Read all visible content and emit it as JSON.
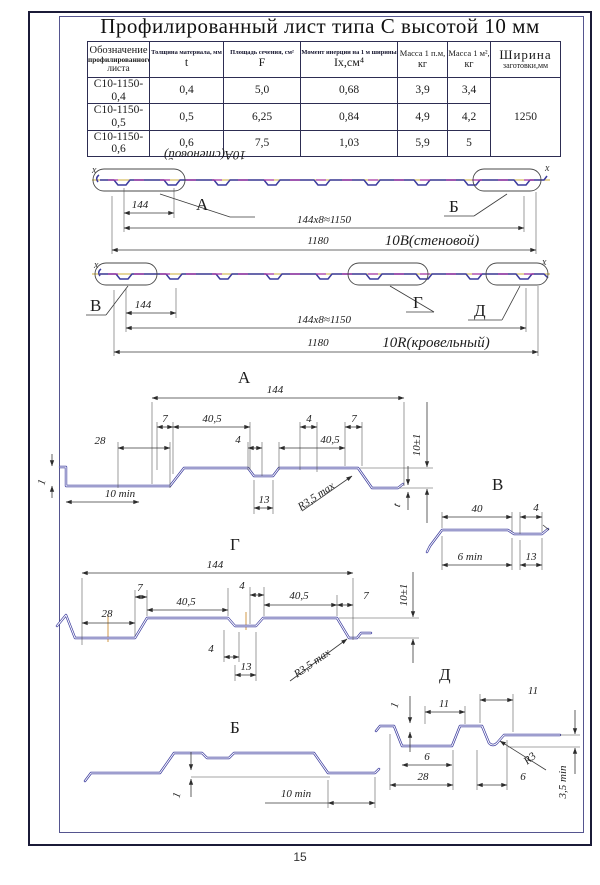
{
  "page_number": "15",
  "title": "Профилированный лист типа С высотой 10 мм",
  "table": {
    "col1_line1": "Обозначение",
    "col1_line2": "профилированного",
    "col1_line3": "листа",
    "col2_name": "Толщина материала, мм",
    "col2_sym": "t",
    "col3_name": "Площадь сечения, см²",
    "col3_sym": "F",
    "col4_name": "Момент инерции на 1 м ширины",
    "col4_sym": "Iх,см⁴",
    "col5_line1": "Масса 1 п.м,",
    "col5_line2": "кг",
    "col6_line1": "Масса 1 м²,",
    "col6_line2": "кг",
    "col7_line1": "Ширина",
    "col7_line2": "заготовки,мм",
    "rows": [
      {
        "name": "С10-1150-0,4",
        "t": "0,4",
        "F": "5,0",
        "I": "0,68",
        "m1": "3,9",
        "m2": "3,4"
      },
      {
        "name": "С10-1150-0,5",
        "t": "0,5",
        "F": "6,25",
        "I": "0,84",
        "m1": "4,9",
        "m2": "4,2"
      },
      {
        "name": "С10-1150-0,6",
        "t": "0,6",
        "F": "7,5",
        "I": "1,03",
        "m1": "5,9",
        "m2": "5"
      }
    ],
    "blank_width": "1250"
  },
  "strip_wall": {
    "flipped_label": "10А(стеновой)",
    "label_a": "А",
    "label_b": "Б",
    "axis_l": "х",
    "axis_r": "х",
    "dim_pitch": "144",
    "dim_total": "144х8≈1150",
    "dim_width": "1180",
    "type_label": "10В(стеновой)"
  },
  "strip_roof": {
    "label_v": "В",
    "label_g": "Г",
    "label_d": "Д",
    "axis_l": "х",
    "axis_r": "х",
    "dim_pitch": "144",
    "dim_total": "144х8≈1150",
    "dim_width": "1180",
    "type_label": "10R(кровельный)"
  },
  "detail_a": {
    "label": "А",
    "dim_144": "144",
    "dim_7l": "7",
    "dim_405l": "40,5",
    "dim_4r": "4",
    "dim_7r": "7",
    "dim_28": "28",
    "dim_4c": "4",
    "dim_405r": "40,5",
    "dim_10min": "10 min",
    "dim_13": "13",
    "dim_r": "R3,5 max",
    "dim_1": "1",
    "dim_10pm": "10±1",
    "dim_t": "t"
  },
  "detail_v": {
    "label": "В",
    "dim_40": "40",
    "dim_4": "4",
    "dim_6min": "6 min",
    "dim_13": "13"
  },
  "detail_g": {
    "label": "Г",
    "dim_144": "144",
    "dim_7l": "7",
    "dim_405l": "40,5",
    "dim_4t": "4",
    "dim_405r": "40,5",
    "dim_7r": "7",
    "dim_28": "28",
    "dim_10pm": "10±1",
    "dim_4b": "4",
    "dim_13": "13",
    "dim_r": "R3,5 max"
  },
  "detail_b": {
    "label": "Б",
    "dim_1": "1",
    "dim_10min": "10 min"
  },
  "detail_d": {
    "label": "Д",
    "dim_1": "1",
    "dim_11l": "11",
    "dim_11r": "11",
    "dim_6l": "6",
    "dim_28": "28",
    "dim_6r": "6",
    "dim_r": "R3",
    "dim_35": "3,5 min"
  }
}
